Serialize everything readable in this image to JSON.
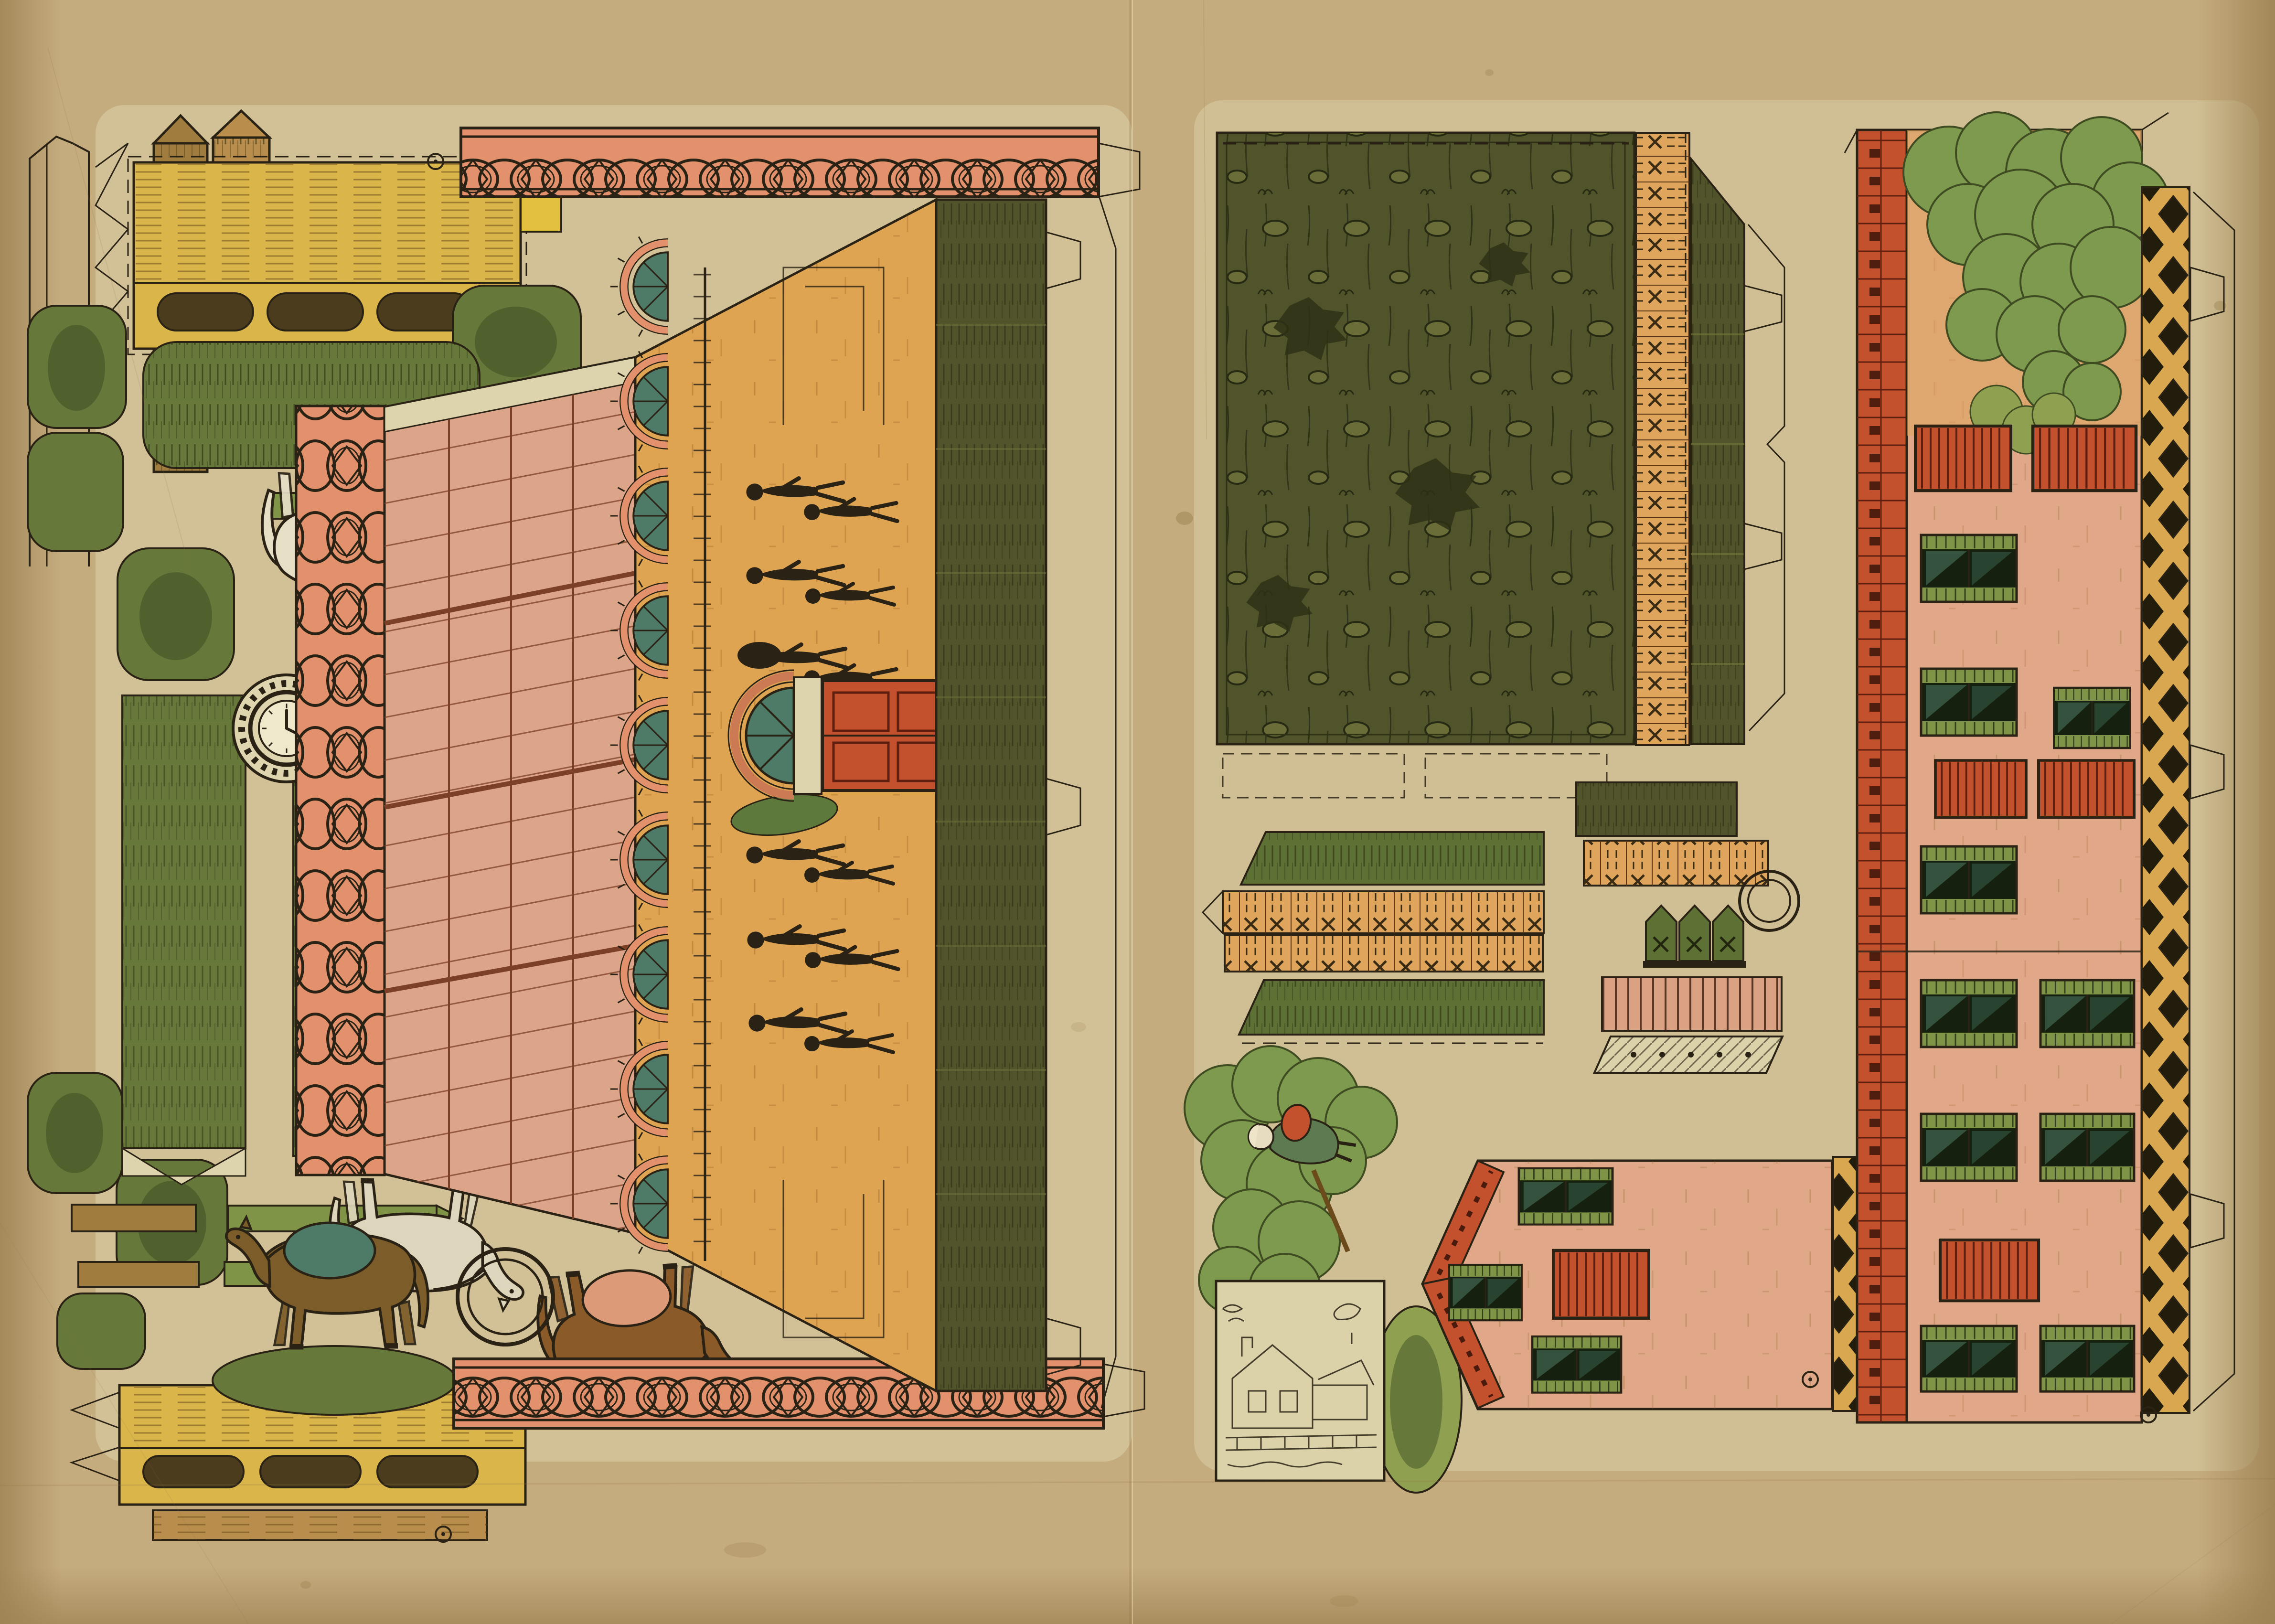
{
  "sheet": {
    "kind": "vintage-paper-model-cutout-sheet",
    "pages": 2,
    "text_content": "none"
  },
  "colors": {
    "paper": "#c5ac7e",
    "paper_edge": "#9c8152",
    "print_bg": "#dcd2aa",
    "ink": "#2a2315",
    "salmon": "#e2916c",
    "salmon_deep": "#b85c38",
    "pink": "#dca489",
    "pink_line": "#7c4026",
    "ochre": "#dfa452",
    "ochre_line": "#8a5a20",
    "olive": "#51542a",
    "olive_dark": "#23260f",
    "hedge": "#66793a",
    "hedge_dark": "#46592a",
    "teal": "#4e7a68",
    "redorange": "#c4512d",
    "red_dark": "#4a1a0c",
    "gold": "#d9b54a",
    "frieze_gold": "#d8a74f",
    "wood": "#a07c3e",
    "wood_dark": "#6b4a1c",
    "cream": "#ddd3ad",
    "tree": "#7e9a4e",
    "tree_dark": "#3f4c22",
    "horse_white": "#e6dfc6",
    "horse_dark": "#2f2917",
    "horse_olive": "#4c5026",
    "horse_brown": "#7c5c28",
    "horse_chestnut": "#8a5a28",
    "field_line": "#262a12",
    "stain": "#8a6f3f",
    "orange_fence": "#dfa55c"
  },
  "left_page": {
    "pieces": [
      "stable-roof-ridge-crest-top",
      "stable-roof-ridge-crest-bottom",
      "knotwork-border-strip",
      "pink-plank-roof-panel",
      "ochre-side-wall",
      "arched-window",
      "fanlight-window",
      "red-paneled-door",
      "dark-roof-slope-band",
      "clock-medallion",
      "hay-trough-bench-top",
      "hay-trough-bench-bottom",
      "wooden-post",
      "cut-outline-strip",
      "hedge-row",
      "round-bush",
      "pointed-stake",
      "wood-rail",
      "cut-ring",
      "registration-mark",
      "strolling-figures"
    ],
    "horse_count": 5,
    "arched_window_count": 9,
    "cut_ring_count": 2
  },
  "right_page": {
    "pieces": [
      "meadow-ground-panel",
      "x-pattern-fence-band",
      "hedge-band",
      "picket-gate-piece",
      "pink-slat-roof-piece",
      "hatched-base-strip",
      "farm-facade-wall",
      "roof-tile-border",
      "diamond-frieze-border",
      "shuttered-window",
      "red-slat-door",
      "gable-house-wall",
      "garden-tree",
      "woman-figure",
      "green-oval-mound",
      "assembly-vignette",
      "cut-ring",
      "registration-mark",
      "fold-line"
    ],
    "shuttered_window_count": 14,
    "red_slat_door_count": 6,
    "cut_ring_count": 2
  }
}
